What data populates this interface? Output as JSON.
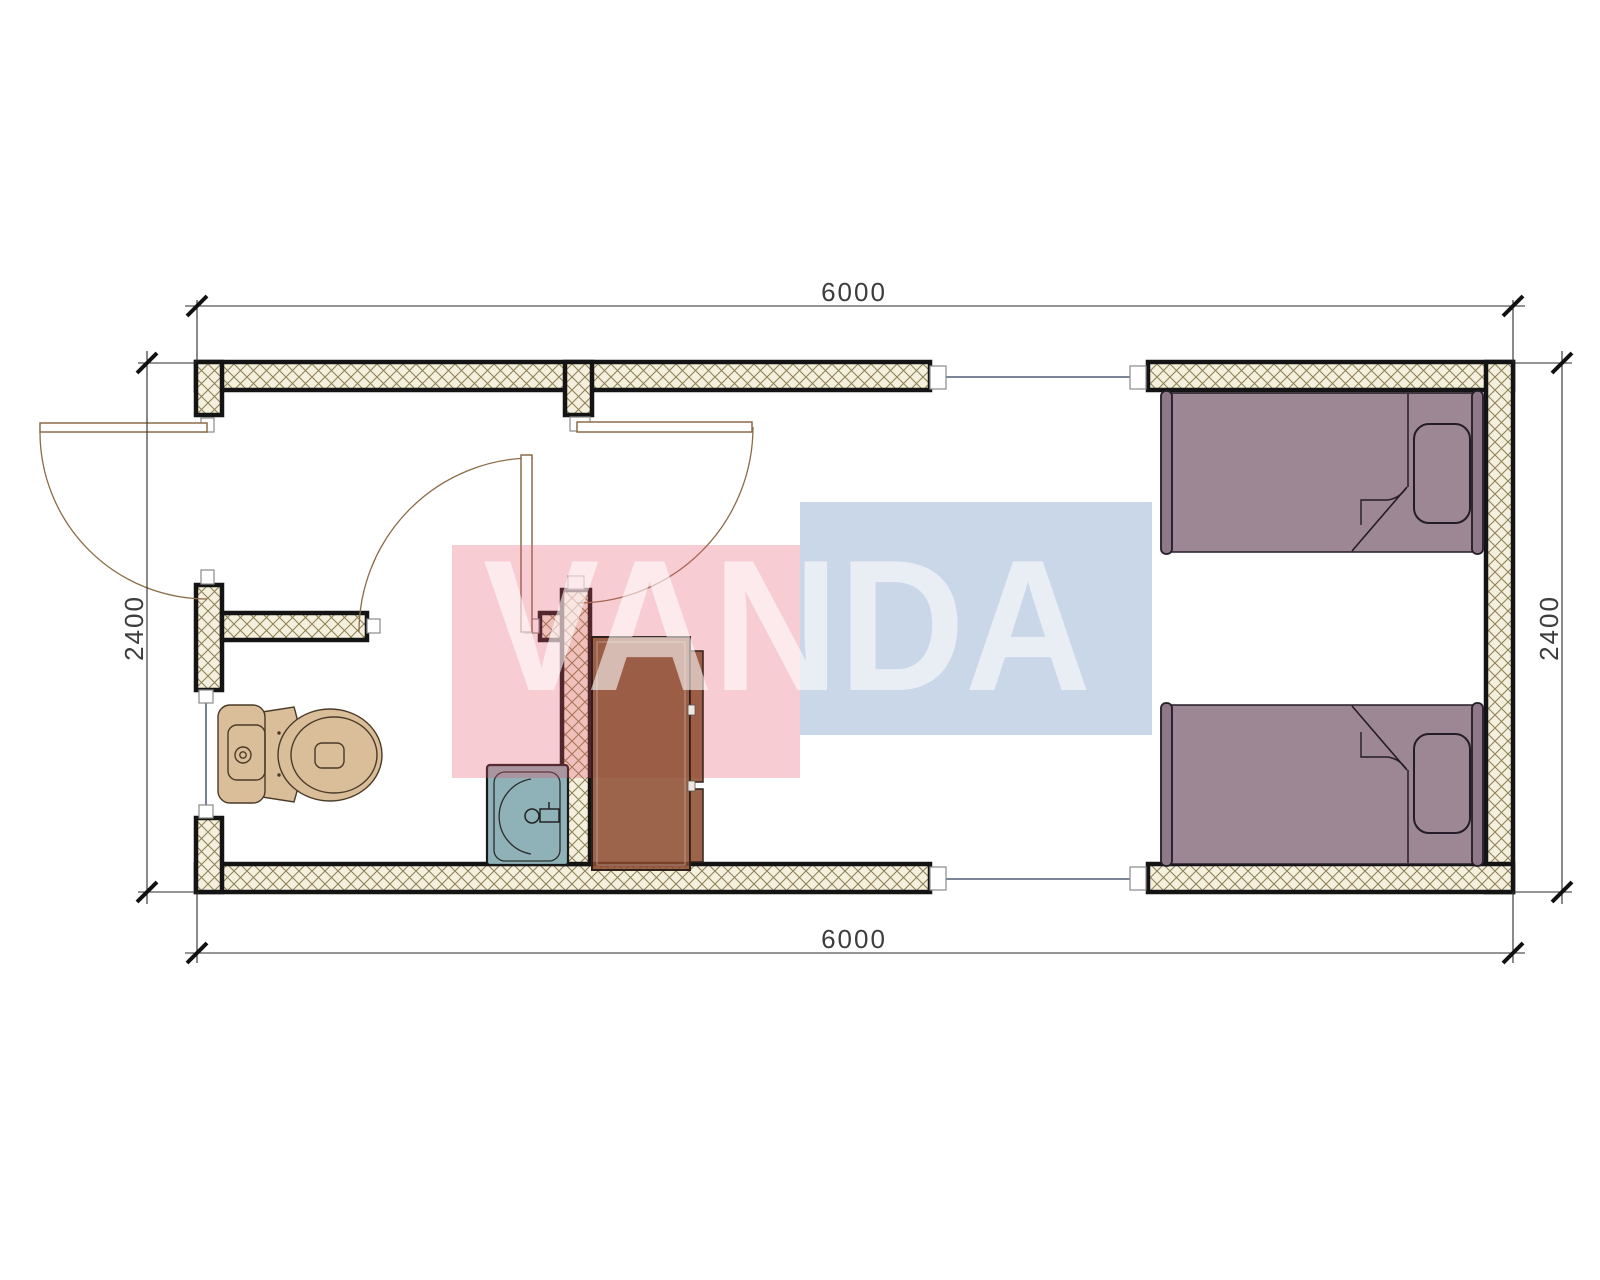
{
  "watermark": {
    "text": "VANDA",
    "pink_block": "#e55569",
    "blue_block": "#688cbd"
  },
  "dimensions": {
    "top": "6000",
    "bottom": "6000",
    "left": "2400",
    "right": "2400"
  },
  "fixtures": {
    "toilet": "toilet",
    "basin": "wash-basin",
    "wardrobe": "wardrobe",
    "bed_top": "single-bed",
    "bed_bottom": "single-bed"
  },
  "colors": {
    "wall_fill": "#f5f0de",
    "hatch_line": "#8f8257",
    "wall_outline": "#141414",
    "fixture_tan": "#dabd99",
    "basin_blue": "#8fb1b8",
    "wardrobe_brown": "#8d4a2e",
    "bed_mauve": "#9d8794",
    "bed_board": "#8f7887",
    "door_line": "#8b6c48",
    "dim_text": "#3d3d3d"
  }
}
